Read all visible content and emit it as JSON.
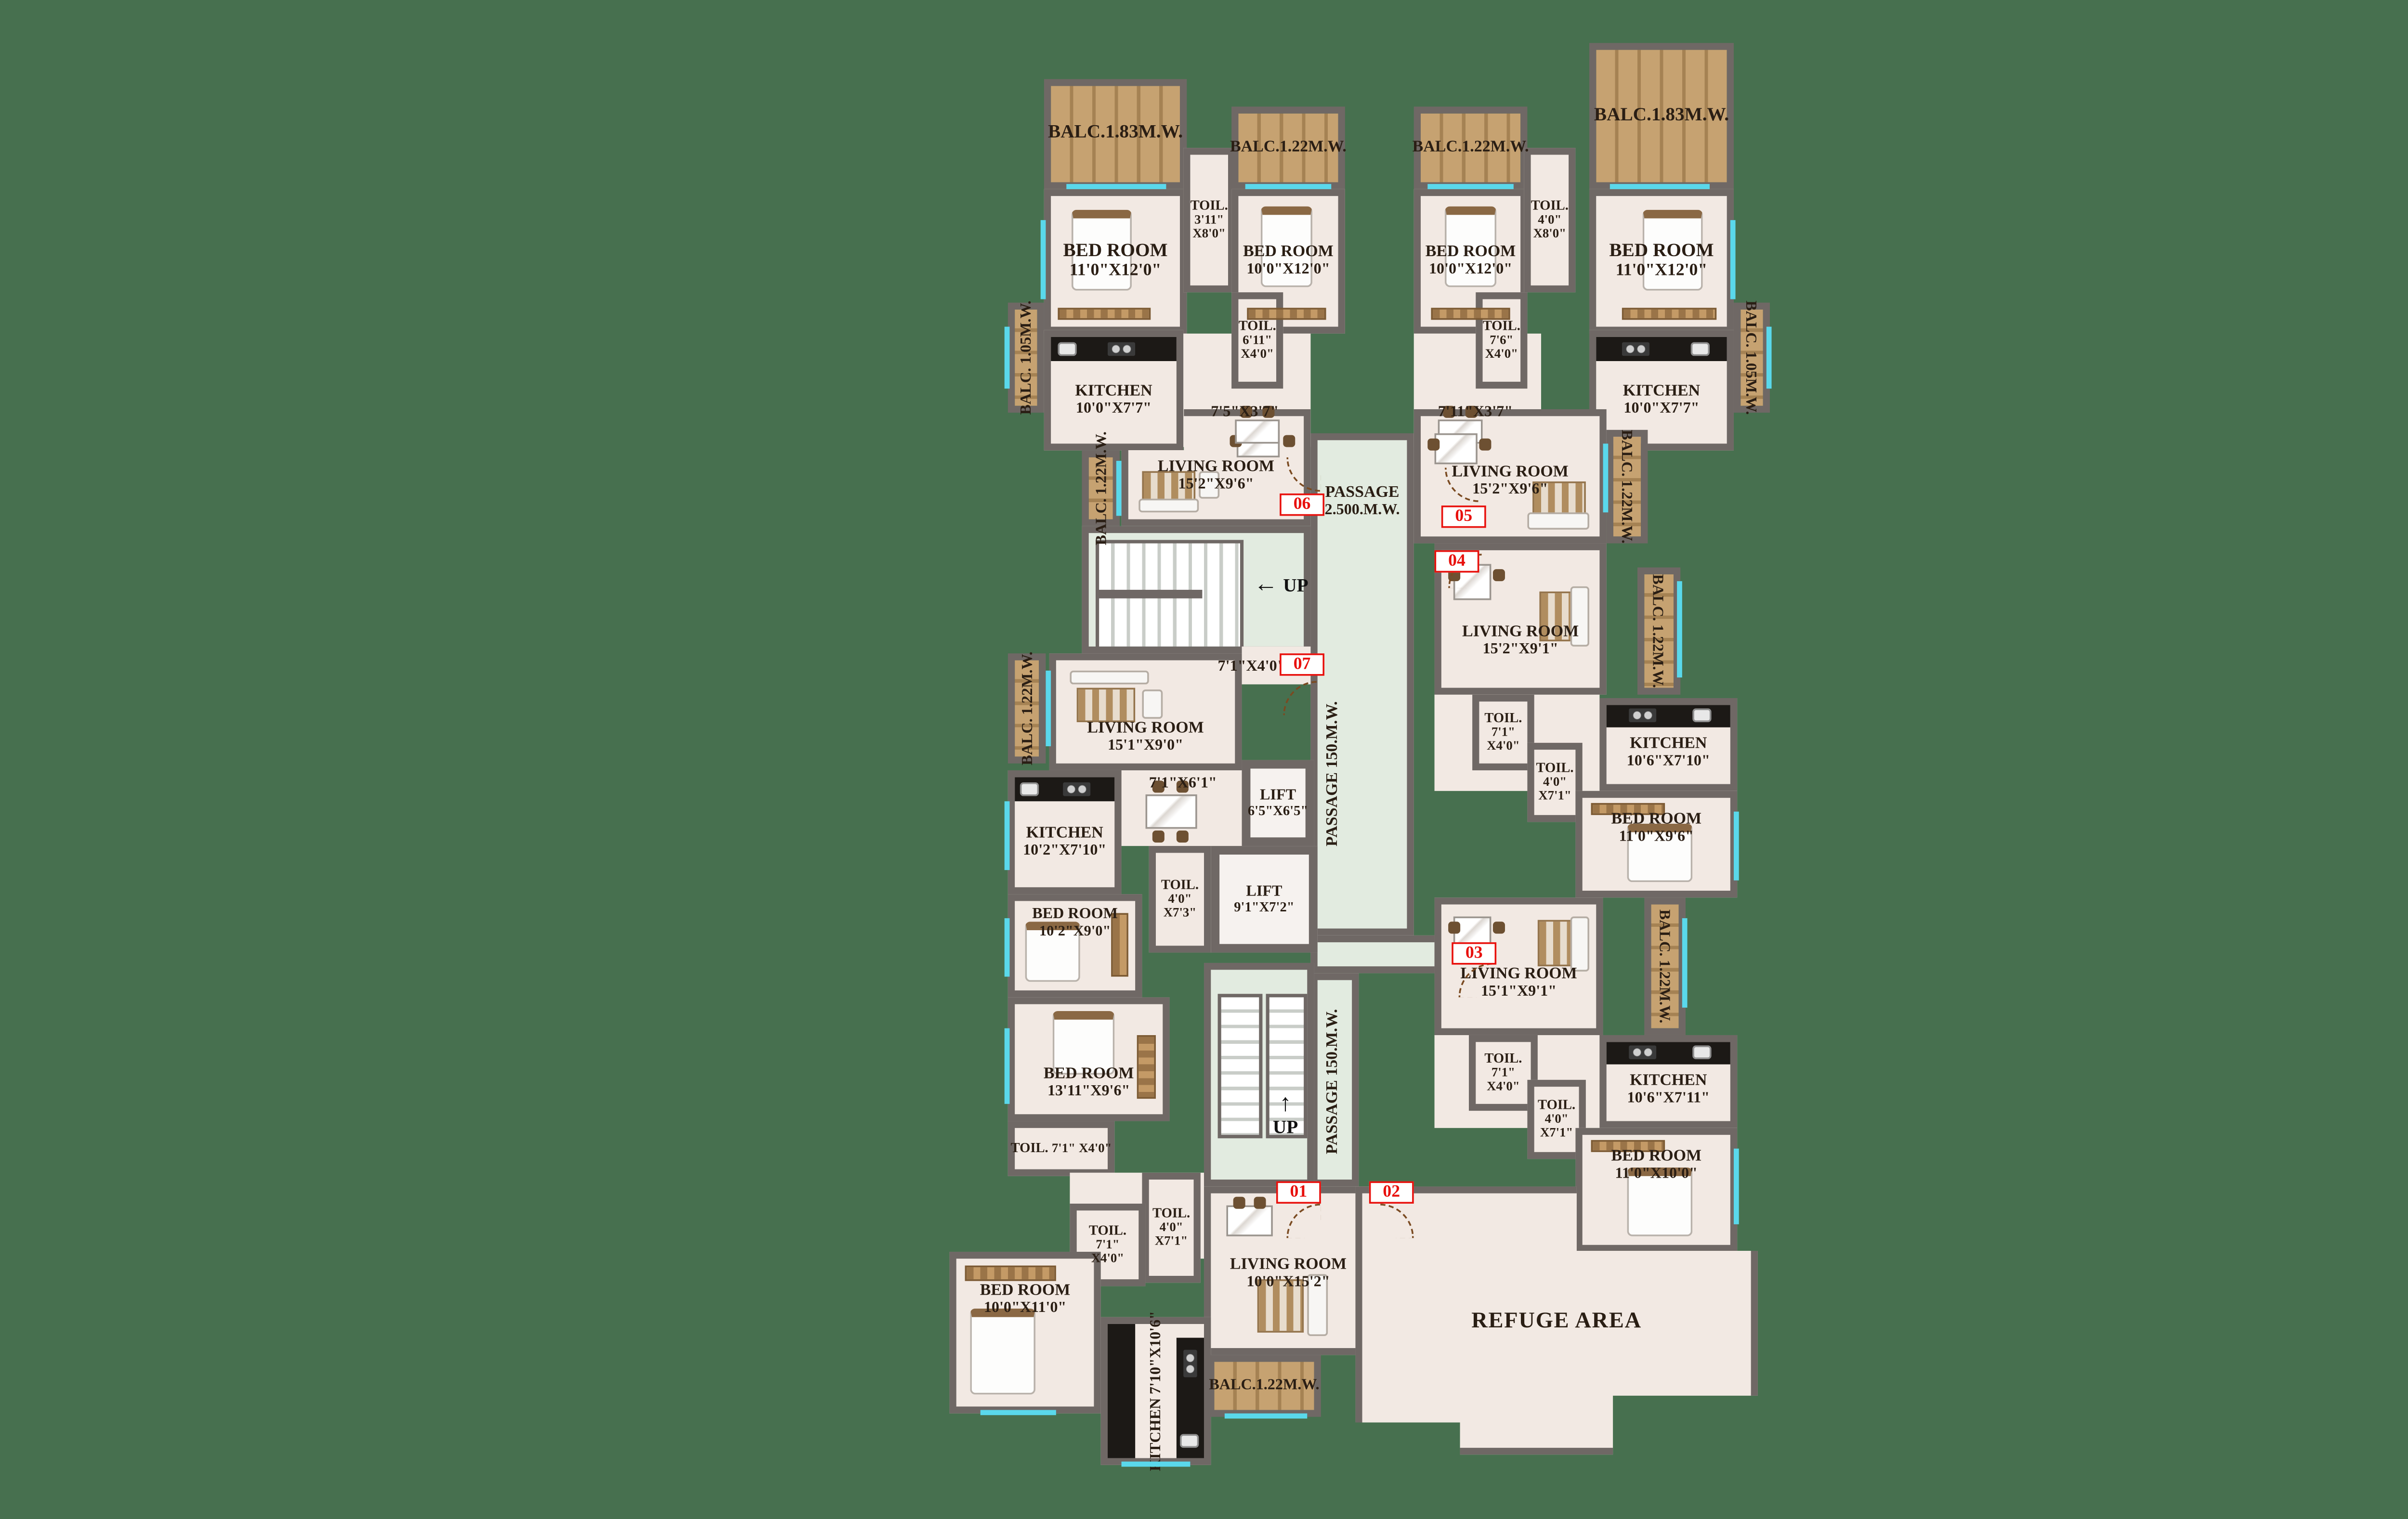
{
  "colors": {
    "background": "#47704F",
    "wall": "#6F6865",
    "floor": "#F2E9E3",
    "passage_floor": "#E2EBE0",
    "balcony_wood": "#C6A271",
    "kitchen_counter": "#1C1916",
    "window_glass": "#5AD8EB",
    "unit_marker_red": "#E8100C",
    "label_text": "#2A1E14"
  },
  "icons": {
    "up_arrow": "↑",
    "left_arrow": "←"
  },
  "markers": {
    "m01": "01",
    "m02": "02",
    "m03": "03",
    "m04": "04",
    "m05": "05",
    "m06": "06",
    "m07": "07"
  },
  "passages": {
    "top": {
      "l1": "PASSAGE",
      "l2": "2.500.M.W."
    },
    "vertical": "PASSAGE 150.M.W."
  },
  "stairs": {
    "up": "UP"
  },
  "lifts": {
    "lift1": {
      "name": "LIFT",
      "dims": "6'5\"X6'5\""
    },
    "lift2": {
      "name": "LIFT",
      "dims": "9'1\"X7'2\""
    }
  },
  "refuge": {
    "name": "REFUGE AREA"
  },
  "door_dims": {
    "d75": "7'5\"X3'7\"",
    "d711": "7'11\"X3'7\"",
    "d71x40": "7'1\"X4'0\"",
    "d71x61": "7'1\"X6'1\""
  },
  "rooms": {
    "balc183_tl": {
      "name": "BALC.1.83M.W."
    },
    "balc122_tl": {
      "name": "BALC.1.22M.W."
    },
    "balc122_tr": {
      "name": "BALC.1.22M.W."
    },
    "balc183_tr": {
      "name": "BALC.1.83M.W."
    },
    "balc105_l": {
      "name": "BALC.",
      "dims": "1.05M.W."
    },
    "balc105_r": {
      "name": "BALC.",
      "dims": "1.05M.W."
    },
    "balc122_a": {
      "name": "BALC.",
      "dims": "1.22M.W."
    },
    "balc122_b": {
      "name": "BALC.",
      "dims": "1.22M.W."
    },
    "balc122_04": {
      "name": "BALC.",
      "dims": "1.22M.W."
    },
    "balc122_07": {
      "name": "BALC.",
      "dims": "1.22M.W."
    },
    "balc122_03": {
      "name": "BALC.",
      "dims": "1.22M.W."
    },
    "balc122_01": {
      "name": "BALC.1.22M.W."
    },
    "bed_a1": {
      "name": "BED ROOM",
      "dims": "11'0\"X12'0\""
    },
    "bed_a2": {
      "name": "BED ROOM",
      "dims": "10'0\"X12'0\""
    },
    "bed_b2": {
      "name": "BED ROOM",
      "dims": "10'0\"X12'0\""
    },
    "bed_b1": {
      "name": "BED ROOM",
      "dims": "11'0\"X12'0\""
    },
    "toil_a": {
      "name": "TOIL.",
      "d1": "3'11\"",
      "d2": "X8'0\""
    },
    "toil_b": {
      "name": "TOIL.",
      "d1": "4'0\"",
      "d2": "X8'0\""
    },
    "toil_a2": {
      "name": "TOIL.",
      "d1": "6'11\"",
      "d2": "X4'0\""
    },
    "toil_b2": {
      "name": "TOIL.",
      "d1": "7'6\"",
      "d2": "X4'0\""
    },
    "kitchen_a": {
      "name": "KITCHEN",
      "dims": "10'0\"X7'7\""
    },
    "kitchen_b": {
      "name": "KITCHEN",
      "dims": "10'0\"X7'7\""
    },
    "living_a": {
      "name": "LIVING ROOM",
      "dims": "15'2\"X9'6\""
    },
    "living_b": {
      "name": "LIVING ROOM",
      "dims": "15'2\"X9'6\""
    },
    "living_04": {
      "name": "LIVING ROOM",
      "dims": "15'2\"X9'1\""
    },
    "toil_04a": {
      "name": "TOIL.",
      "d1": "7'1\"",
      "d2": "X4'0\""
    },
    "toil_04b": {
      "name": "TOIL.",
      "d1": "4'0\"",
      "d2": "X7'1\""
    },
    "kitchen_04": {
      "name": "KITCHEN",
      "dims": "10'6\"X7'10\""
    },
    "bed_04": {
      "name": "BED ROOM",
      "dims": "11'0\"X9'6\""
    },
    "living_07": {
      "name": "LIVING ROOM",
      "dims": "15'1\"X9'0\""
    },
    "kitchen_07": {
      "name": "KITCHEN",
      "dims": "10'2\"X7'10\""
    },
    "toil_07a": {
      "name": "TOIL.",
      "d1": "4'0\"",
      "d2": "X7'3\""
    },
    "bed_07a": {
      "name": "BED ROOM",
      "dims": "10'2\"X9'0\""
    },
    "bed_07b": {
      "name": "BED ROOM",
      "dims": "13'11\"X9'6\""
    },
    "toil_07b": {
      "name": "TOIL.",
      "d1": "7'1\"",
      "d2": "X4'0\""
    },
    "living_03": {
      "name": "LIVING ROOM",
      "dims": "15'1\"X9'1\""
    },
    "toil_03a": {
      "name": "TOIL.",
      "d1": "7'1\"",
      "d2": "X4'0\""
    },
    "toil_03b": {
      "name": "TOIL.",
      "d1": "4'0\"",
      "d2": "X7'1\""
    },
    "kitchen_03": {
      "name": "KITCHEN",
      "dims": "10'6\"X7'11\""
    },
    "bed_03": {
      "name": "BED ROOM",
      "dims": "11'0\"X10'0\""
    },
    "toil_01a": {
      "name": "TOIL.",
      "d1": "4'0\"",
      "d2": "X7'1\""
    },
    "toil_01b": {
      "name": "TOIL.",
      "d1": "7'1\"",
      "d2": "X4'0\""
    },
    "bed_01": {
      "name": "BED ROOM",
      "dims": "10'0\"X11'0\""
    },
    "living_01": {
      "name": "LIVING ROOM",
      "dims": "10'0\"X15'2\""
    },
    "kitchen_01": {
      "name": "KITCHEN",
      "dims": "7'10\"X10'6\""
    }
  }
}
